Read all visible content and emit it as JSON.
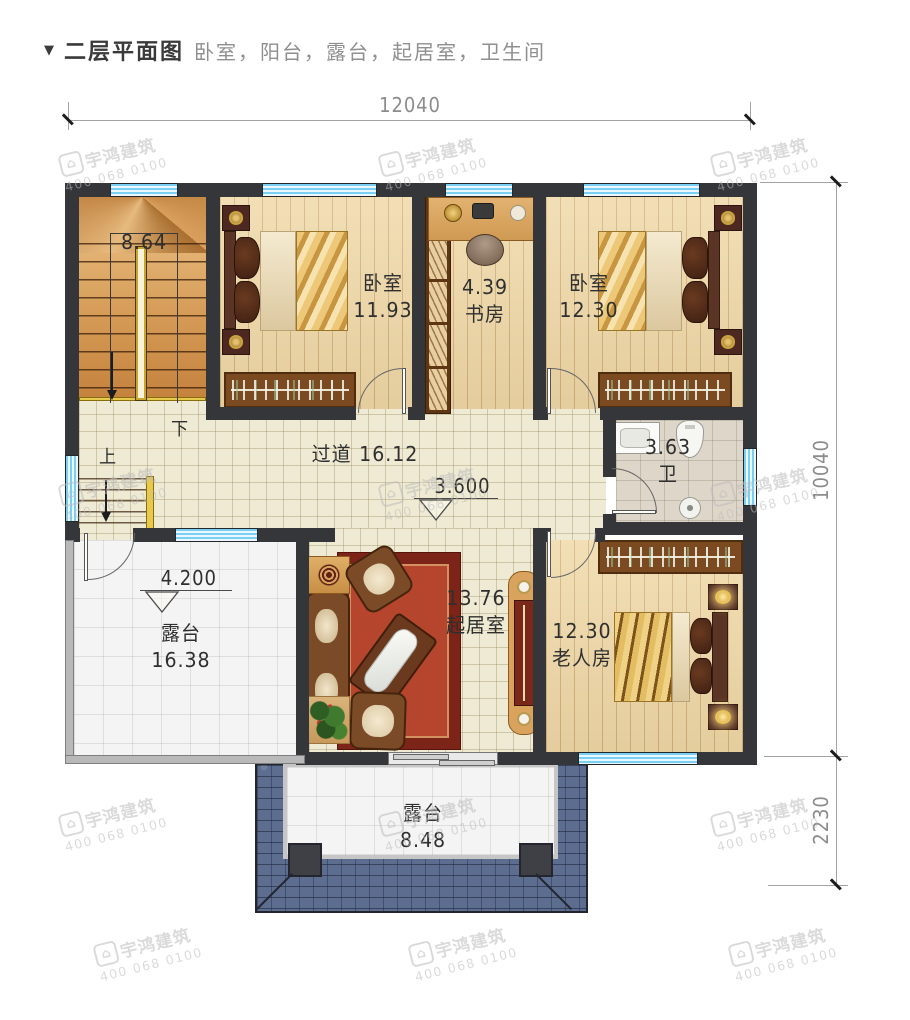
{
  "header": {
    "marker": "▼",
    "title": "二层平面图",
    "subtitle": "卧室，阳台，露台，起居室，卫生间"
  },
  "dimensions": {
    "width_top": "12040",
    "height_main": "10040",
    "height_terrace": "2230"
  },
  "levels": {
    "hall_elevation": "3.600",
    "terrace_elevation": "4.200"
  },
  "rooms": {
    "stairwell": {
      "area": "8.64",
      "down_label": "下",
      "up_label": "上"
    },
    "bedroom_top_left": {
      "name": "卧室",
      "area": "11.93"
    },
    "study": {
      "name": "书房",
      "area": "4.39"
    },
    "bedroom_top_right": {
      "name": "卧室",
      "area": "12.30"
    },
    "hallway": {
      "name": "过道",
      "area": "16.12"
    },
    "bathroom": {
      "name": "卫",
      "area": "3.63"
    },
    "terrace_left": {
      "name": "露台",
      "area": "16.38"
    },
    "living_room": {
      "name": "起居室",
      "area": "13.76"
    },
    "elder_room": {
      "name": "老人房",
      "area": "12.30"
    },
    "terrace_bottom": {
      "name": "露台",
      "area": "8.48"
    }
  },
  "watermark": {
    "brand": "宇鸿建筑",
    "phone": "400 068 0100"
  },
  "colors": {
    "wall": "#34363a",
    "window_glass": "#7ad0f2",
    "wood_floor": "#f0d8a6",
    "hall_tile": "#efead3",
    "terrace_tile": "#f4f4f4",
    "bath_tile": "#ddd6c9",
    "roof_tile": "#5c6d90",
    "rug": "#b5452c",
    "rug_border": "#7c2418",
    "stair_wood": "#d49a55",
    "parapet": "#b9b9b9",
    "label_ink": "#2f2f2f",
    "dimension_ink": "#8c8c8c",
    "watermark": "#bdbdbd"
  }
}
